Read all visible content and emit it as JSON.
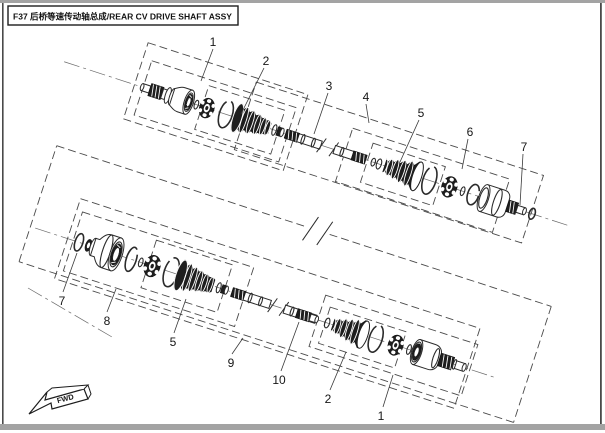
{
  "title": {
    "text": "F37 后桥等速传动轴总成/REAR CV DRIVE SHAFT ASSY"
  },
  "direction_marker": {
    "label": "FWD"
  },
  "callouts": [
    {
      "id": "u1",
      "label": "1"
    },
    {
      "id": "u2",
      "label": "2"
    },
    {
      "id": "u3",
      "label": "3"
    },
    {
      "id": "u4",
      "label": "4"
    },
    {
      "id": "u5",
      "label": "5"
    },
    {
      "id": "u6",
      "label": "6"
    },
    {
      "id": "u7",
      "label": "7"
    },
    {
      "id": "l7",
      "label": "7"
    },
    {
      "id": "l8",
      "label": "8"
    },
    {
      "id": "l5",
      "label": "5"
    },
    {
      "id": "l9",
      "label": "9"
    },
    {
      "id": "l10",
      "label": "10"
    },
    {
      "id": "l2",
      "label": "2"
    },
    {
      "id": "l1",
      "label": "1"
    }
  ],
  "colors": {
    "line": "#2b2b2b",
    "dashed_box": "#4a4a4a",
    "dark_fill": "#1e1e1e",
    "frame_grey": "#a3a3a3",
    "background": "#ffffff"
  }
}
